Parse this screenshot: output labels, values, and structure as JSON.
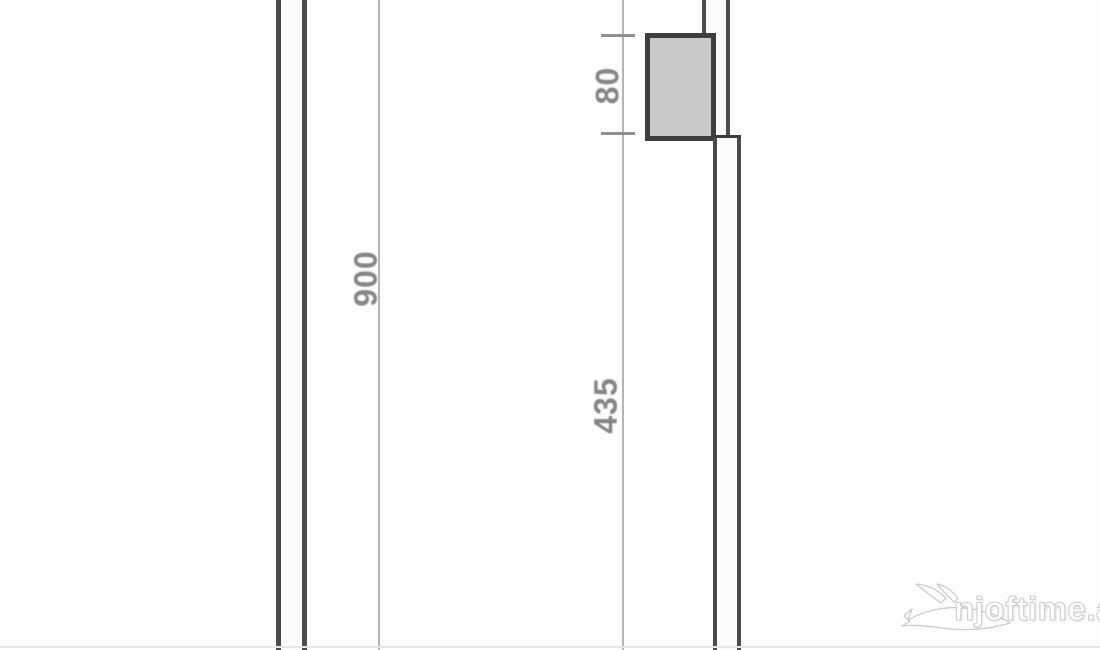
{
  "drawing": {
    "type": "scanned-floor-plan-wall-section",
    "dim_900": {
      "label": "900"
    },
    "dim_80": {
      "label": "80"
    },
    "dim_435": {
      "label": "435"
    },
    "colors": {
      "background": "#fdfdfd",
      "wall": "#4b4b4b",
      "dimline": "#b5b5b5",
      "dimtext": "#858585",
      "tick": "#8f8f8f",
      "colfill": "#c9c9c9",
      "colborder": "#3e3e3e",
      "watermark_fill": "#ffffff",
      "watermark_outline": "#cfcfcf"
    }
  },
  "watermark": {
    "text": "njoftime.al",
    "icon": "swallow-bird-icon"
  }
}
